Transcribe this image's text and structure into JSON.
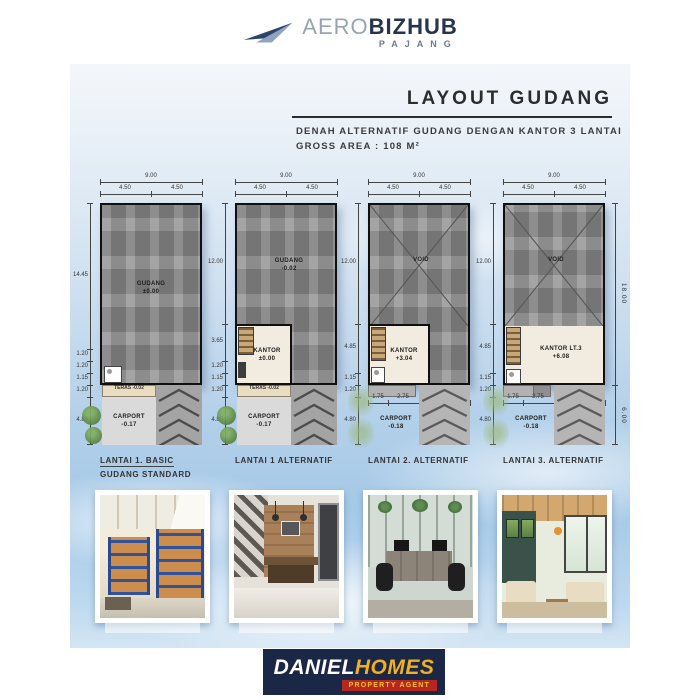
{
  "brand_top": {
    "aero": "AERO",
    "bizhub": "BIZHUB",
    "subtitle": "PAJANG"
  },
  "header": {
    "title": "LAYOUT GUDANG",
    "subtitle_line1": "DENAH ALTERNATIF GUDANG DENGAN KANTOR 3 LANTAI",
    "subtitle_line2": "GROSS AREA : 108 M²"
  },
  "plans": [
    {
      "caption1": "LANTAI 1. BASIC",
      "caption2": "GUDANG STANDARD",
      "top_total": "9.00",
      "top_left": "4.50",
      "top_right": "4.50",
      "side": [
        "14.45",
        "1.20",
        "1.20",
        "1.15",
        "1.20",
        "4.80"
      ],
      "main": "GUDANG",
      "main_level": "±0.00",
      "teras": "TERAS",
      "teras_level": "-0.02",
      "carport": "CARPORT",
      "carport_level": "-0.17"
    },
    {
      "caption1": "LANTAI 1 ALTERNATIF",
      "top_total": "9.00",
      "top_left": "4.50",
      "top_right": "4.50",
      "side": [
        "12.00",
        "3.65",
        "1.20",
        "1.15",
        "1.20",
        "4.80"
      ],
      "main": "GUDANG",
      "main_level": "-0.02",
      "kantor": "KANTOR",
      "kantor_level": "±0.00",
      "teras": "TERAS",
      "teras_level": "-0.02",
      "carport": "CARPORT",
      "carport_level": "-0.17"
    },
    {
      "caption1": "LANTAI 2. ALTERNATIF",
      "top_total": "9.00",
      "top_left": "4.50",
      "top_right": "4.50",
      "side": [
        "12.00",
        "4.85",
        "1.15",
        "1.20",
        "4.80"
      ],
      "main": "VOID",
      "kantor": "KANTOR",
      "kantor_level": "+3.04",
      "bottom": [
        "1.75",
        "2.75",
        "4.50"
      ],
      "carport": "CARPORT",
      "carport_level": "-0.18"
    },
    {
      "caption1": "LANTAI 3. ALTERNATIF",
      "top_total": "9.00",
      "top_left": "4.50",
      "top_right": "4.50",
      "side": [
        "12.00",
        "4.85",
        "1.15",
        "1.20",
        "4.80"
      ],
      "right": [
        "18.00",
        "6.00"
      ],
      "main": "VOID",
      "kantor": "KANTOR LT.3",
      "kantor_level": "+6.08",
      "bottom": [
        "1.75",
        "2.75",
        "4.50"
      ],
      "carport": "CARPORT",
      "carport_level": "-0.18"
    }
  ],
  "brand_bottom": {
    "daniel": "DANIEL",
    "homes": "HOMES",
    "tagline": "PROPERTY AGENT"
  },
  "colors": {
    "navy": "#1b2747",
    "yellow": "#f2b01e",
    "red": "#b5271f",
    "sky": "#a5c9e7",
    "plan_gray": "#8d8d8d",
    "kantor_cream": "#f1ecdf",
    "teras_beige": "#e9dcc0"
  }
}
